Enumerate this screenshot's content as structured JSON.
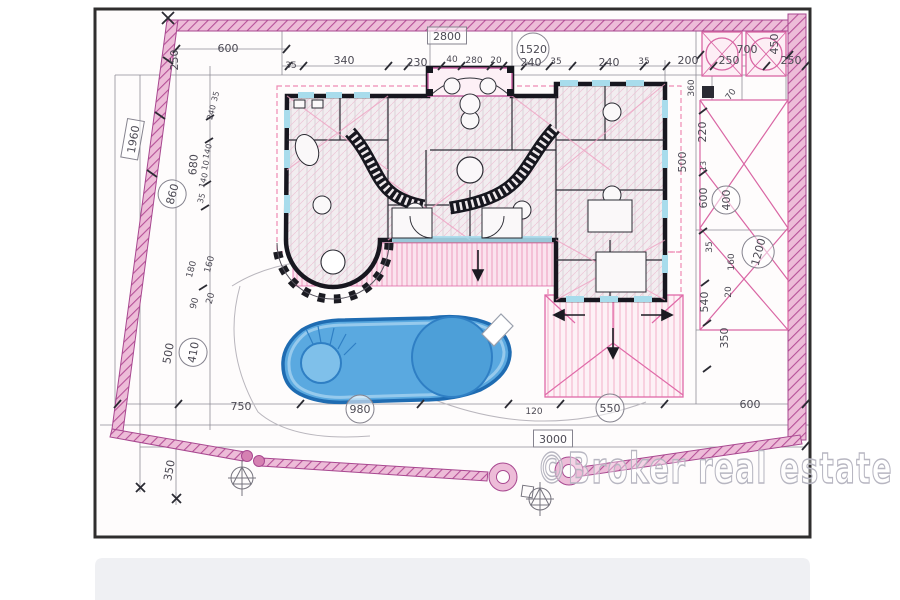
{
  "page": {
    "watermark": "©Broker real estate"
  },
  "drawing": {
    "type": "architectural-site-plan",
    "description": "Hand-drawn villa floor plan with swimming pool, pink property boundary walls and dimension chains",
    "colors": {
      "boundary_pink": "#b65198",
      "boundary_fill": "#edbcd8",
      "roof_pink": "#f0a6c4",
      "wall_black": "#17171f",
      "window_accent": "#a8dcec",
      "pool_fill": "#5aa9e0",
      "pool_edge": "#1f6cb2",
      "pencil_gray": "#8f8d96",
      "label_ink": "#4c4a54",
      "watermark_gray": "#b7b6c1"
    },
    "labels": [
      {
        "text": "600",
        "x": 228,
        "y": 52
      },
      {
        "text": "250",
        "x": 178,
        "y": 60,
        "rot": -90
      },
      {
        "text": "2800",
        "x": 447,
        "y": 40,
        "enc": "box"
      },
      {
        "text": "1520",
        "x": 533,
        "y": 53,
        "enc": "circle"
      },
      {
        "text": "35",
        "x": 291,
        "y": 68,
        "size": 9
      },
      {
        "text": "340",
        "x": 344,
        "y": 64
      },
      {
        "text": "230",
        "x": 417,
        "y": 66
      },
      {
        "text": "40",
        "x": 452,
        "y": 62,
        "size": 9
      },
      {
        "text": "280",
        "x": 474,
        "y": 63,
        "size": 9
      },
      {
        "text": "20",
        "x": 496,
        "y": 63,
        "size": 9
      },
      {
        "text": "240",
        "x": 531,
        "y": 66
      },
      {
        "text": "35",
        "x": 556,
        "y": 64,
        "size": 9
      },
      {
        "text": "240",
        "x": 609,
        "y": 66
      },
      {
        "text": "35",
        "x": 644,
        "y": 64,
        "size": 9
      },
      {
        "text": "200",
        "x": 688,
        "y": 64
      },
      {
        "text": "250",
        "x": 729,
        "y": 64
      },
      {
        "text": "250",
        "x": 791,
        "y": 64
      },
      {
        "text": "700",
        "x": 747,
        "y": 53
      },
      {
        "text": "450",
        "x": 778,
        "y": 44,
        "rot": -90
      },
      {
        "text": "360",
        "x": 694,
        "y": 88,
        "rot": -90,
        "size": 9
      },
      {
        "text": "70",
        "x": 733,
        "y": 96,
        "rot": -55,
        "size": 9
      },
      {
        "text": "220",
        "x": 706,
        "y": 132,
        "rot": -90
      },
      {
        "text": "500",
        "x": 686,
        "y": 162,
        "rot": -90
      },
      {
        "text": "13",
        "x": 706,
        "y": 166,
        "rot": -90,
        "size": 8
      },
      {
        "text": "600",
        "x": 707,
        "y": 198,
        "rot": -90
      },
      {
        "text": "400",
        "x": 730,
        "y": 200,
        "rot": -90,
        "enc": "circle"
      },
      {
        "text": "35",
        "x": 712,
        "y": 247,
        "rot": -90,
        "size": 9
      },
      {
        "text": "160",
        "x": 734,
        "y": 262,
        "rot": -90,
        "size": 9
      },
      {
        "text": "1200",
        "x": 762,
        "y": 253,
        "rot": -75,
        "enc": "circle"
      },
      {
        "text": "540",
        "x": 708,
        "y": 302,
        "rot": -90
      },
      {
        "text": "20",
        "x": 731,
        "y": 292,
        "rot": -90,
        "size": 9
      },
      {
        "text": "350",
        "x": 728,
        "y": 338,
        "rot": -90
      },
      {
        "text": "600",
        "x": 750,
        "y": 408
      },
      {
        "text": "1960",
        "x": 137,
        "y": 140,
        "rot": -80,
        "enc": "box"
      },
      {
        "text": "680",
        "x": 197,
        "y": 165,
        "rot": -85
      },
      {
        "text": "860",
        "x": 176,
        "y": 195,
        "rot": -75,
        "enc": "circle"
      },
      {
        "text": "35",
        "x": 218,
        "y": 97,
        "rot": -75,
        "size": 8
      },
      {
        "text": "240",
        "x": 214,
        "y": 113,
        "rot": -75,
        "size": 8
      },
      {
        "text": "140",
        "x": 210,
        "y": 152,
        "rot": -75,
        "size": 8
      },
      {
        "text": "10",
        "x": 208,
        "y": 166,
        "rot": -75,
        "size": 8
      },
      {
        "text": "140",
        "x": 206,
        "y": 181,
        "rot": -75,
        "size": 8
      },
      {
        "text": "35",
        "x": 204,
        "y": 199,
        "rot": -75,
        "size": 8
      },
      {
        "text": "180",
        "x": 194,
        "y": 270,
        "rot": -75,
        "size": 9
      },
      {
        "text": "160",
        "x": 212,
        "y": 265,
        "rot": -75,
        "size": 9
      },
      {
        "text": "90",
        "x": 197,
        "y": 304,
        "rot": -75,
        "size": 9
      },
      {
        "text": "20",
        "x": 213,
        "y": 299,
        "rot": -75,
        "size": 9
      },
      {
        "text": "500",
        "x": 172,
        "y": 354,
        "rot": -80
      },
      {
        "text": "410",
        "x": 197,
        "y": 353,
        "rot": -80,
        "enc": "circle"
      },
      {
        "text": "350",
        "x": 173,
        "y": 471,
        "rot": -80
      },
      {
        "text": "750",
        "x": 241,
        "y": 410
      },
      {
        "text": "980",
        "x": 360,
        "y": 413,
        "enc": "circle"
      },
      {
        "text": "120",
        "x": 534,
        "y": 414,
        "size": 9
      },
      {
        "text": "550",
        "x": 610,
        "y": 412,
        "enc": "circle"
      },
      {
        "text": "3000",
        "x": 553,
        "y": 443,
        "enc": "box"
      }
    ]
  }
}
